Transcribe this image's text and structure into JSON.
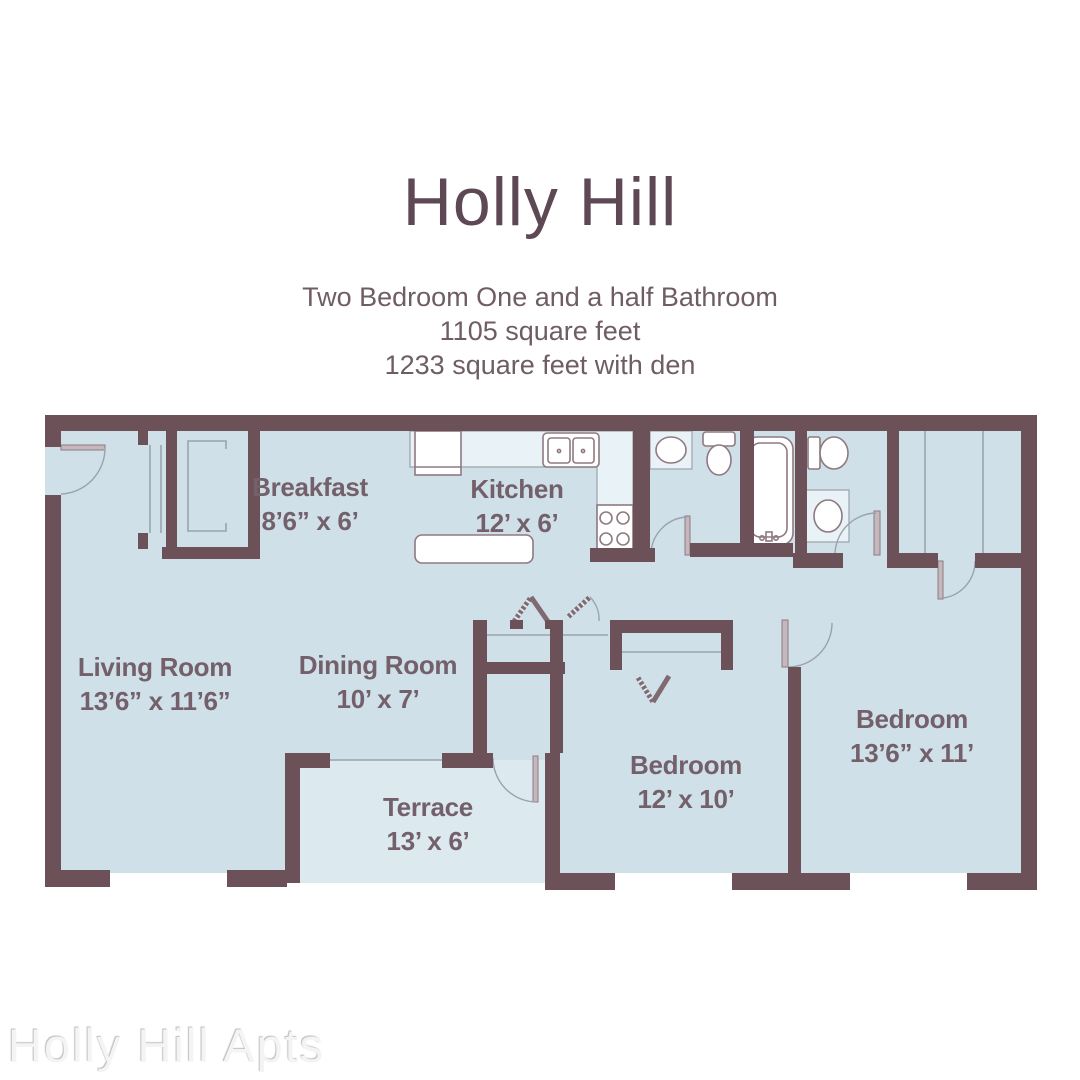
{
  "header": {
    "title": "Holly Hill",
    "subtitle_line1": "Two Bedroom One and a half Bathroom",
    "subtitle_line2": "1105 square feet",
    "subtitle_line3": "1233 square feet with den"
  },
  "watermark": "Holly Hill Apts",
  "rooms": [
    {
      "name": "Breakfast",
      "dims": "8’6” x 6’"
    },
    {
      "name": "Kitchen",
      "dims": "12’ x 6’"
    },
    {
      "name": "Living Room",
      "dims": "13’6” x 11’6”"
    },
    {
      "name": "Dining Room",
      "dims": "10’ x 7’"
    },
    {
      "name": "Terrace",
      "dims": "13’ x 6’"
    },
    {
      "name": "Bedroom",
      "dims": "12’ x 10’"
    },
    {
      "name": "Bedroom",
      "dims": "13’6” x 11’"
    }
  ],
  "fixtures": [
    "refrigerator",
    "kitchen-double-sink",
    "range-4-burners",
    "island-counter",
    "half-bath-vanity-sink",
    "half-bath-toilet",
    "bathtub",
    "bath-toilet",
    "bath-vanity-sink",
    "entry-closet-sliding-doors",
    "utility-closet",
    "bedroom-closet-bifold-doors",
    "wardrobe-closet"
  ],
  "colors": {
    "wall": "#6d5158",
    "floor": "#cfe0e9",
    "terrace_floor": "#dce9ef",
    "counter": "#e9f2f6",
    "fixture_outline": "#8e7a81",
    "line": "#9aa3ab",
    "title_color": "#5d4854",
    "subtitle_color": "#6f5d64",
    "label_color": "#73606a",
    "watermark_color": "#f4f4f4"
  }
}
